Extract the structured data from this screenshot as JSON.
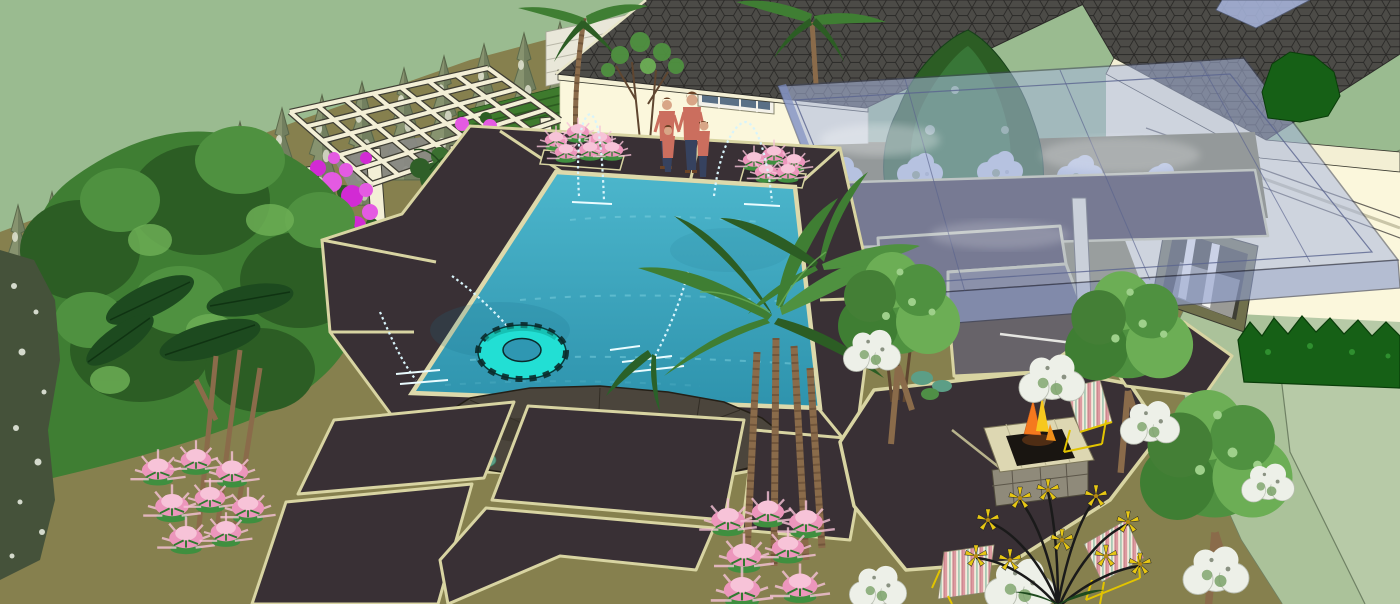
{
  "canvas": {
    "width": 1400,
    "height": 604
  },
  "scene": {
    "type": "3d-landscape-model-render",
    "view": "aerial-perspective-backyard-pool-design",
    "objects": {
      "pool": {
        "shape": "rectangular",
        "float": "inner-tube",
        "fountain_jets": 5,
        "accent": "boulder"
      },
      "structures": [
        "main-house",
        "right-wing",
        "glass-canopy",
        "pergola",
        "privacy-screens",
        "fire-pit",
        "green-slat-wall",
        "white-fence"
      ],
      "furniture": [
        "yellow-bistro-table",
        "striped-deck-chairs",
        "striped-lounge-chairs",
        "potted-plant"
      ],
      "people": {
        "adults": 2,
        "children": 2
      },
      "planting": [
        "cypress-row",
        "palm-trees",
        "leafy-trees",
        "bougainvillea",
        "pink-astilbe",
        "white-flower-shrubs",
        "blue-white-flower-bed",
        "yellow-flower-plant",
        "dark-hedge"
      ]
    }
  },
  "colors": {
    "sky": "#9abb90",
    "plane": "#b7caa7",
    "planeShade": "#abc29a",
    "planeLine": "#6f8164",
    "yard": "#86804e",
    "bed": "#7b7546",
    "slab": "#393035",
    "slabGray": "#676369",
    "joint": "#d8d4a2",
    "coping": "#ddd9ab",
    "poolDeep": "#2e93ad",
    "poolShallow": "#4cb6cc",
    "splash": "#d8f4fb",
    "wall": "#fbf7dc",
    "fascia": "#f3efd4",
    "roof": "#4c4b47",
    "roofLine": "#2b2a28",
    "glass": "#aab8e0",
    "glassFront": "#8f9fce",
    "glassFrame": "#5a648e",
    "pergola": "#f3efd6",
    "beamShadow": "#3f3e34",
    "screen": "#161616",
    "bougain": "#d22ad4",
    "bougainLight": "#e45ae2",
    "astilbe": "#ec96bc",
    "astilbeLight": "#f7c3d8",
    "whiteFlower": "#edf0e8",
    "bloomBlue": "#c6d0e2",
    "leaf": "#4f9140",
    "leafMid": "#3f7e33",
    "leafDark": "#2c5d24",
    "leafLight": "#6cae55",
    "cypress": "#87936f",
    "cypressLight": "#e2e4d2",
    "trunk": "#8a6b4a",
    "trunkDark": "#5f4630",
    "rock": "#4b453c",
    "rockLine": "#241f16",
    "floatCyan": "#22dfd4",
    "floatDark": "#0b2a2a",
    "fireOrange": "#f5791e",
    "fireYellow": "#f7c81e",
    "frameYellow": "#e2c400",
    "tableYellow": "#d8d400",
    "shirt": "#cb6e5e",
    "pants": "#36425f",
    "skin": "#d8a687",
    "hair": "#6b4326",
    "hedge": "#166016",
    "hedgeDark": "#0a3d0a",
    "stem": "#1a1a1a",
    "starYellow": "#e7c714",
    "fence": "#e9e7d9",
    "fenceLine": "#b9b7a8",
    "greenWall": "#3e7a2d",
    "greenWallLine": "#2c5c20",
    "winGlass": "#5a7086",
    "winFrame": "#70704c",
    "pot": "#b86a3e",
    "stone": "#8f8a7a",
    "tealShrub": "#5c9e86"
  }
}
